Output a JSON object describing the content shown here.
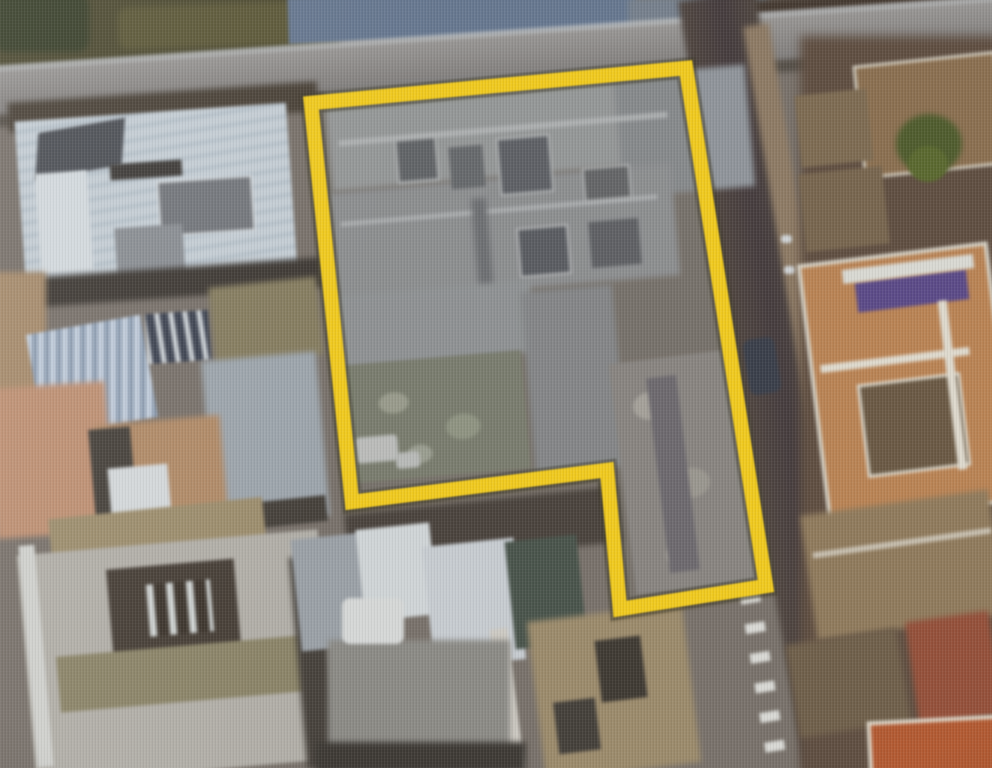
{
  "scene": {
    "type": "aerial-satellite-photo",
    "description": "Oblique photo of a screen showing satellite imagery of a dense town block; one irregular property parcel is outlined with a thick yellow boundary; streets run along the top and down the right side of the parcel; terracotta and white rooftops surround it."
  },
  "parcel": {
    "label": "highlighted-parcel",
    "outline_color": "#EFC91F",
    "outline_shadow_color": "#413f35",
    "stroke_width": 14.5,
    "shadow_stroke_width": 21,
    "points": "311,103 686,68 766,586 620,609 607,470 352,502",
    "interior_tint": "rgba(138,142,146,0.22)"
  },
  "palette": {
    "road_top": "#8e8b88",
    "road_right": "#4a3f3a",
    "vegetation_dark": "#4e4b33",
    "big_blue_roof": "#66778f",
    "white_roofs": "#c3ccd3",
    "terracotta": "#b98354",
    "salmon_ground": "#bd8f72",
    "tan_roofs": "#9b8a6b",
    "orange_red_building": "#b25a32",
    "pool_purple": "#5b4a87",
    "tree_green": "#4f5c2e"
  }
}
